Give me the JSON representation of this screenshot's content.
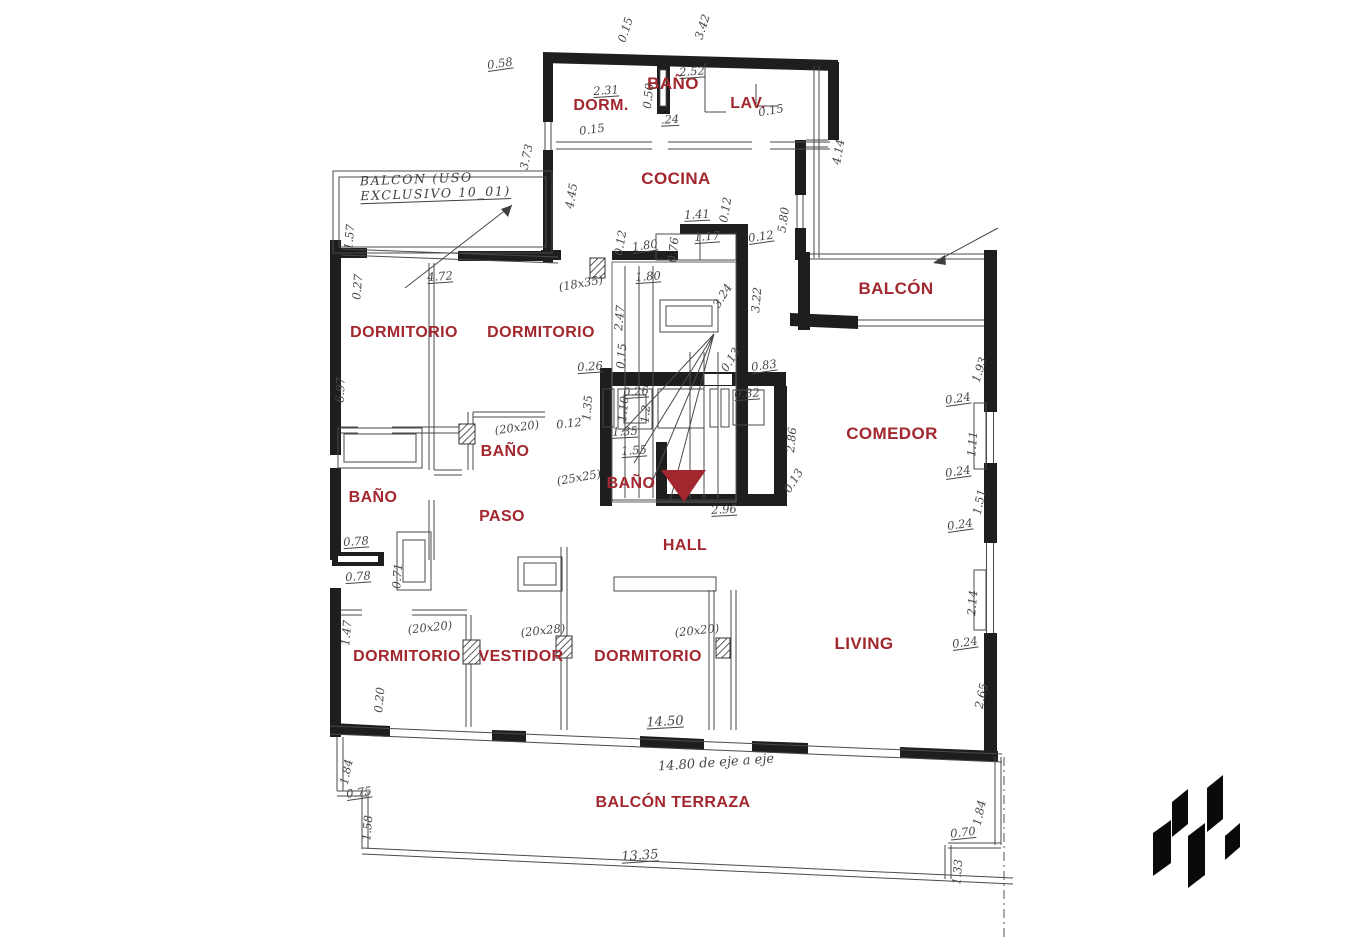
{
  "page": {
    "width": 1354,
    "height": 950,
    "background": "#ffffff",
    "type": "architectural-floor-plan-scan"
  },
  "colors": {
    "label_red": "#a2272e",
    "pencil_gray": "#474747",
    "wall_black": "#1e1e1e",
    "logo_black": "#0a0a0a"
  },
  "logo": {
    "icon": "geometric-zigzag-logo-icon",
    "color": "#0a0a0a"
  },
  "floor_plan": {
    "entry_marker": {
      "icon": "entry-triangle-marker-icon",
      "color": "#a2272e"
    },
    "notes": {
      "balcony_note": {
        "line1": "BALCON (USO",
        "line2": "EXCLUSIVO 10_01)"
      }
    },
    "rooms": [
      {
        "id": "bano-top",
        "label": "BAÑO",
        "x": 673,
        "y": 84,
        "size": 17
      },
      {
        "id": "dorm",
        "label": "DORM.",
        "x": 601,
        "y": 106,
        "size": 16
      },
      {
        "id": "lav",
        "label": "LAV.",
        "x": 748,
        "y": 104,
        "size": 16
      },
      {
        "id": "cocina",
        "label": "COCINA",
        "x": 676,
        "y": 179,
        "size": 17
      },
      {
        "id": "balcon",
        "label": "BALCÓN",
        "x": 896,
        "y": 289,
        "size": 17
      },
      {
        "id": "dormitorio-1",
        "label": "DORMITORIO",
        "x": 404,
        "y": 333,
        "size": 16
      },
      {
        "id": "dormitorio-2",
        "label": "DORMITORIO",
        "x": 541,
        "y": 333,
        "size": 16
      },
      {
        "id": "bano-mid",
        "label": "BAÑO",
        "x": 505,
        "y": 452,
        "size": 16
      },
      {
        "id": "bano-left",
        "label": "BAÑO",
        "x": 373,
        "y": 498,
        "size": 16
      },
      {
        "id": "paso",
        "label": "PASO",
        "x": 502,
        "y": 517,
        "size": 16
      },
      {
        "id": "bano-center",
        "label": "BAÑO",
        "x": 631,
        "y": 484,
        "size": 16
      },
      {
        "id": "hall",
        "label": "HALL",
        "x": 685,
        "y": 546,
        "size": 16
      },
      {
        "id": "comedor",
        "label": "COMEDOR",
        "x": 892,
        "y": 434,
        "size": 17
      },
      {
        "id": "dormitorio-3",
        "label": "DORMITORIO",
        "x": 407,
        "y": 657,
        "size": 16
      },
      {
        "id": "vestidor",
        "label": "VESTIDOR",
        "x": 521,
        "y": 657,
        "size": 16
      },
      {
        "id": "dormitorio-4",
        "label": "DORMITORIO",
        "x": 648,
        "y": 657,
        "size": 16
      },
      {
        "id": "living",
        "label": "LIVING",
        "x": 864,
        "y": 644,
        "size": 17
      },
      {
        "id": "balcon-terraza",
        "label": "BALCÓN TERRAZA",
        "x": 673,
        "y": 803,
        "size": 16
      }
    ],
    "dimensions": [
      {
        "t": "0.15",
        "x": 626,
        "y": 30,
        "r": -72
      },
      {
        "t": "3.42",
        "x": 703,
        "y": 27,
        "r": -72
      },
      {
        "t": "0.58",
        "x": 500,
        "y": 64,
        "r": -8,
        "u": 1
      },
      {
        "t": "2.31",
        "x": 606,
        "y": 91,
        "r": -4,
        "u": 1
      },
      {
        "t": "2.52",
        "x": 692,
        "y": 72,
        "r": -4,
        "u": 1
      },
      {
        "t": "0.50",
        "x": 649,
        "y": 96,
        "r": -84
      },
      {
        "t": ".24",
        "x": 670,
        "y": 120,
        "r": -2,
        "u": 1
      },
      {
        "t": "0.15",
        "x": 771,
        "y": 111,
        "r": -10
      },
      {
        "t": "0.15",
        "x": 592,
        "y": 130,
        "r": -8
      },
      {
        "t": "3.73",
        "x": 527,
        "y": 157,
        "r": -78
      },
      {
        "t": "4.45",
        "x": 572,
        "y": 196,
        "r": -80
      },
      {
        "t": "4.14",
        "x": 839,
        "y": 152,
        "r": -80
      },
      {
        "t": "5.80",
        "x": 784,
        "y": 220,
        "r": -82
      },
      {
        "t": "1.57",
        "x": 350,
        "y": 237,
        "r": -85
      },
      {
        "t": "0.27",
        "x": 358,
        "y": 287,
        "r": -85
      },
      {
        "t": "4.72",
        "x": 440,
        "y": 277,
        "r": -4,
        "u": 1
      },
      {
        "t": "(18x35)",
        "x": 581,
        "y": 284,
        "r": -10
      },
      {
        "t": "6.97",
        "x": 341,
        "y": 390,
        "r": -88
      },
      {
        "t": "1.41",
        "x": 697,
        "y": 215,
        "r": -3,
        "u": 1
      },
      {
        "t": "0.12",
        "x": 726,
        "y": 210,
        "r": -80
      },
      {
        "t": "1.80",
        "x": 645,
        "y": 246,
        "r": -8,
        "u": 1
      },
      {
        "t": "0.12",
        "x": 621,
        "y": 243,
        "r": -80
      },
      {
        "t": "0.76",
        "x": 674,
        "y": 250,
        "r": -84
      },
      {
        "t": "1.17",
        "x": 707,
        "y": 237,
        "r": -4,
        "u": 1
      },
      {
        "t": "0.12",
        "x": 761,
        "y": 237,
        "r": -8,
        "u": 1
      },
      {
        "t": "1.80",
        "x": 648,
        "y": 277,
        "r": -4,
        "u": 1
      },
      {
        "t": "3.22",
        "x": 757,
        "y": 300,
        "r": -85
      },
      {
        "t": "3.24",
        "x": 723,
        "y": 296,
        "r": -58
      },
      {
        "t": "2.47",
        "x": 620,
        "y": 318,
        "r": -85
      },
      {
        "t": "0.15",
        "x": 622,
        "y": 356,
        "r": -85
      },
      {
        "t": "0.26",
        "x": 590,
        "y": 367,
        "r": -4,
        "u": 1
      },
      {
        "t": "0.13",
        "x": 731,
        "y": 360,
        "r": -58
      },
      {
        "t": "0.83",
        "x": 764,
        "y": 366,
        "r": -8,
        "u": 1
      },
      {
        "t": "0.26",
        "x": 636,
        "y": 392,
        "r": -4,
        "u": 1
      },
      {
        "t": "1.10",
        "x": 624,
        "y": 409,
        "r": -85
      },
      {
        "t": "1.2",
        "x": 646,
        "y": 414,
        "r": -85
      },
      {
        "t": "1.35",
        "x": 588,
        "y": 408,
        "r": -85
      },
      {
        "t": "0.12",
        "x": 569,
        "y": 424,
        "r": -6
      },
      {
        "t": "1.35",
        "x": 625,
        "y": 432,
        "r": -3,
        "u": 1
      },
      {
        "t": "0.82",
        "x": 747,
        "y": 394,
        "r": -4,
        "u": 1
      },
      {
        "t": "2.86",
        "x": 792,
        "y": 440,
        "r": -85
      },
      {
        "t": "1.55",
        "x": 634,
        "y": 451,
        "r": -4,
        "u": 1
      },
      {
        "t": "(25x25)",
        "x": 579,
        "y": 478,
        "r": -10
      },
      {
        "t": "(20x20)",
        "x": 517,
        "y": 428,
        "r": -8
      },
      {
        "t": "2.96",
        "x": 724,
        "y": 510,
        "r": -3,
        "u": 1
      },
      {
        "t": "0.13",
        "x": 794,
        "y": 481,
        "r": -58
      },
      {
        "t": "0.78",
        "x": 356,
        "y": 542,
        "r": -4,
        "u": 1
      },
      {
        "t": "0.78",
        "x": 358,
        "y": 577,
        "r": -4,
        "u": 1
      },
      {
        "t": "0.71",
        "x": 398,
        "y": 576,
        "r": -85
      },
      {
        "t": "1.93",
        "x": 980,
        "y": 370,
        "r": -72
      },
      {
        "t": "0.24",
        "x": 958,
        "y": 399,
        "r": -8,
        "u": 1
      },
      {
        "t": "1.11",
        "x": 973,
        "y": 444,
        "r": -85
      },
      {
        "t": "0.24",
        "x": 958,
        "y": 472,
        "r": -8,
        "u": 1
      },
      {
        "t": "1.51",
        "x": 980,
        "y": 502,
        "r": -78
      },
      {
        "t": "0.24",
        "x": 960,
        "y": 525,
        "r": -8,
        "u": 1
      },
      {
        "t": "2.14",
        "x": 973,
        "y": 603,
        "r": -85
      },
      {
        "t": "0.24",
        "x": 965,
        "y": 643,
        "r": -8,
        "u": 1
      },
      {
        "t": "2.65",
        "x": 982,
        "y": 696,
        "r": -78
      },
      {
        "t": "1.47",
        "x": 347,
        "y": 633,
        "r": -85
      },
      {
        "t": "(20x20)",
        "x": 430,
        "y": 628,
        "r": -6
      },
      {
        "t": "(20x28)",
        "x": 543,
        "y": 631,
        "r": -6
      },
      {
        "t": "(20x20)",
        "x": 697,
        "y": 631,
        "r": -6
      },
      {
        "t": "0.20",
        "x": 380,
        "y": 700,
        "r": -85
      },
      {
        "t": "14.50",
        "x": 665,
        "y": 722,
        "r": -3,
        "u": 1,
        "s": 13
      },
      {
        "t": "14.80 de eje a eje",
        "x": 716,
        "y": 763,
        "r": -4,
        "s": 13
      },
      {
        "t": "1.84",
        "x": 347,
        "y": 772,
        "r": -78
      },
      {
        "t": "0.75",
        "x": 359,
        "y": 793,
        "r": -8,
        "u": 1
      },
      {
        "t": "1.58",
        "x": 368,
        "y": 828,
        "r": -85
      },
      {
        "t": "13.35",
        "x": 640,
        "y": 856,
        "r": -4,
        "u": 1,
        "s": 13
      },
      {
        "t": "1.84",
        "x": 980,
        "y": 813,
        "r": -78
      },
      {
        "t": "0.70",
        "x": 963,
        "y": 833,
        "r": -6,
        "u": 1
      },
      {
        "t": "1.33",
        "x": 958,
        "y": 872,
        "r": -85
      }
    ]
  }
}
